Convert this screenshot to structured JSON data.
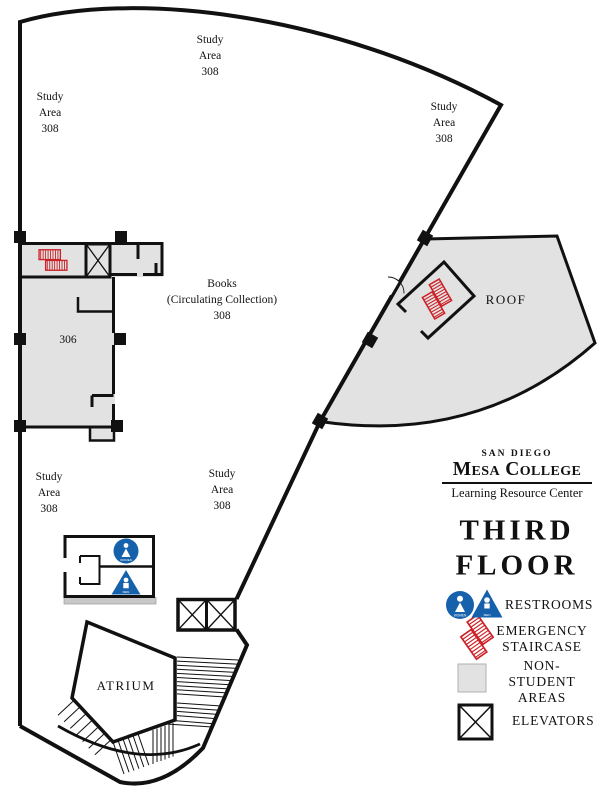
{
  "map": {
    "study_area_label": "Study\nArea\n308",
    "books_label": "Books\n(Circulating Collection)\n308",
    "room_306_label": "306",
    "roof_label": "ROOF",
    "atrium_label": "ATRIUM",
    "restroom_women_label": "WOMEN",
    "restroom_men_label": "MEN"
  },
  "legend": {
    "brand_line1": "SAN DIEGO",
    "brand_line2": "Mesa College",
    "brand_line3": "Learning Resource Center",
    "floor_title": "THIRD\nFLOOR",
    "items": [
      {
        "label": "RESTROOMS"
      },
      {
        "label": "EMERGENCY\nSTAIRCASE"
      },
      {
        "label": "NON-STUDENT\nAREAS"
      },
      {
        "label": "ELEVATORS"
      }
    ],
    "colors": {
      "restroom_blue": "#1661ab",
      "staircase_red": "#cc2127",
      "non_student_gray": "#e2e2e2",
      "wall_black": "#111111"
    }
  }
}
